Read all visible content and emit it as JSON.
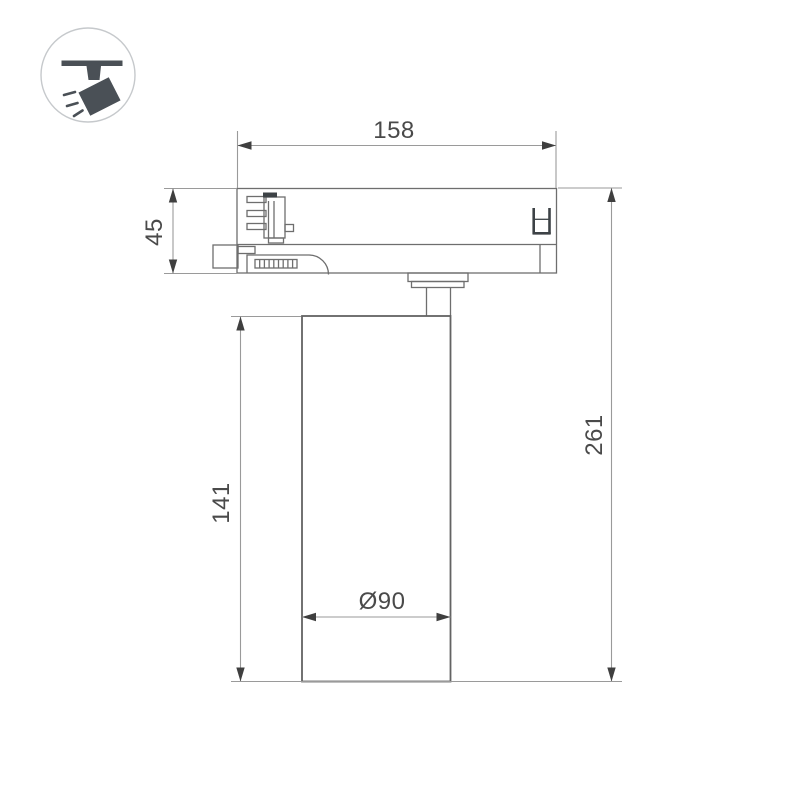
{
  "page": {
    "background": "#ffffff",
    "type": "technical-dimension-drawing",
    "subject": "track-mounted cylindrical spotlight, side view"
  },
  "icon_badge": {
    "name": "track-spotlight-pictogram",
    "description": "circle badge with ceiling track, stem and tilted spotlight head emitting rays",
    "fill": "#4a5056",
    "circle_border": "#c6c9cc"
  },
  "drawing": {
    "dimensions": {
      "adapter_width": "158",
      "adapter_height": "45",
      "body_height": "141",
      "total_height": "261",
      "body_diameter": "Ø90"
    },
    "colors": {
      "outline": "#6e6e6e",
      "outline_heavy": "#636363",
      "dimension_line": "#9a9a9a",
      "arrow_fill": "#3f3f3f",
      "dimension_text": "#4a4a4a",
      "accent_dark": "#3d4246",
      "background": "#ffffff"
    }
  }
}
